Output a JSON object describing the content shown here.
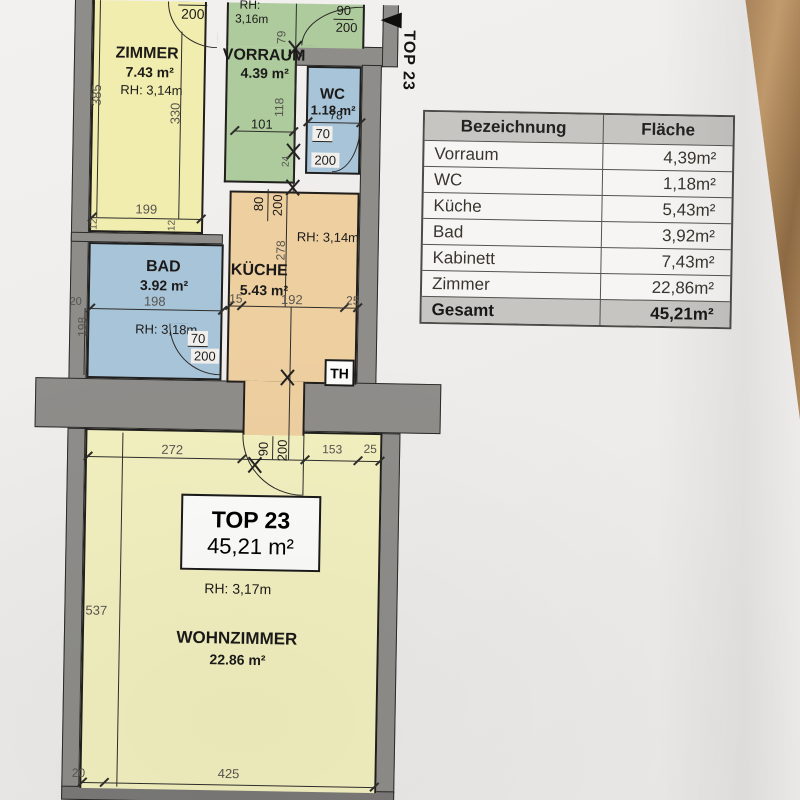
{
  "colors": {
    "paper": "#f1efec",
    "wall_gray": "#8e8d8a",
    "room_yellow": "#f1edae",
    "room_green": "#aecb9d",
    "room_blue": "#a8c4d8",
    "room_orange": "#eecfa0",
    "room_pale_yellow": "#f2f0bf",
    "table_header_bg": "#c7c5c2",
    "wood_table": "#b68a58"
  },
  "floorplan": {
    "entrance_label": "TOP 23",
    "th_label": "TH",
    "unit_box": {
      "title": "TOP 23",
      "area": "45,21 m²"
    },
    "rooms": {
      "zimmer": {
        "name": "ZIMMER",
        "area": "7.43 m²",
        "rh": "RH: 3,14m"
      },
      "vorraum": {
        "name": "VORRAUM",
        "area": "4.39 m²",
        "rh_line1": "RH:",
        "rh_line2": "3,16m"
      },
      "wc": {
        "name": "WC",
        "area": "1.18 m²"
      },
      "bad": {
        "name": "BAD",
        "area": "3.92 m²",
        "rh": "RH: 3,18m"
      },
      "kueche": {
        "name": "KÜCHE",
        "area": "5.43 m²",
        "rh": "RH: 3,14m"
      },
      "wohnzimmer": {
        "name": "WOHNZIMMER",
        "area": "22.86 m²",
        "rh": "RH: 3,17m"
      }
    },
    "dims": {
      "z385": "385",
      "z330": "330",
      "z199": "199",
      "z12a": "12",
      "z12b": "12",
      "zdoor200": "200",
      "v79": "79",
      "v118": "118",
      "v24": "24",
      "v101": "101",
      "edoor90": "90",
      "edoor200": "200",
      "wc78": "78",
      "wcdoor70": "70",
      "wcdoor200": "200",
      "k15": "15",
      "k192": "192",
      "k25": "25",
      "k278": "278",
      "kdoor80": "80",
      "kdoor200": "200",
      "b198h": "198",
      "b198v": "198",
      "b20": "20",
      "bdoor70": "70",
      "bdoor200": "200",
      "w272": "272",
      "wdoor90": "90",
      "wdoor200": "200",
      "w153": "153",
      "w25": "25",
      "w537": "537",
      "w425": "425",
      "w20": "20"
    }
  },
  "table": {
    "headers": [
      "Bezeichnung",
      "Fläche"
    ],
    "rows": [
      [
        "Vorraum",
        "4,39m²"
      ],
      [
        "WC",
        "1,18m²"
      ],
      [
        "Küche",
        "5,43m²"
      ],
      [
        "Bad",
        "3,92m²"
      ],
      [
        "Kabinett",
        "7,43m²"
      ],
      [
        "Zimmer",
        "22,86m²"
      ]
    ],
    "total": [
      "Gesamt",
      "45,21m²"
    ]
  }
}
